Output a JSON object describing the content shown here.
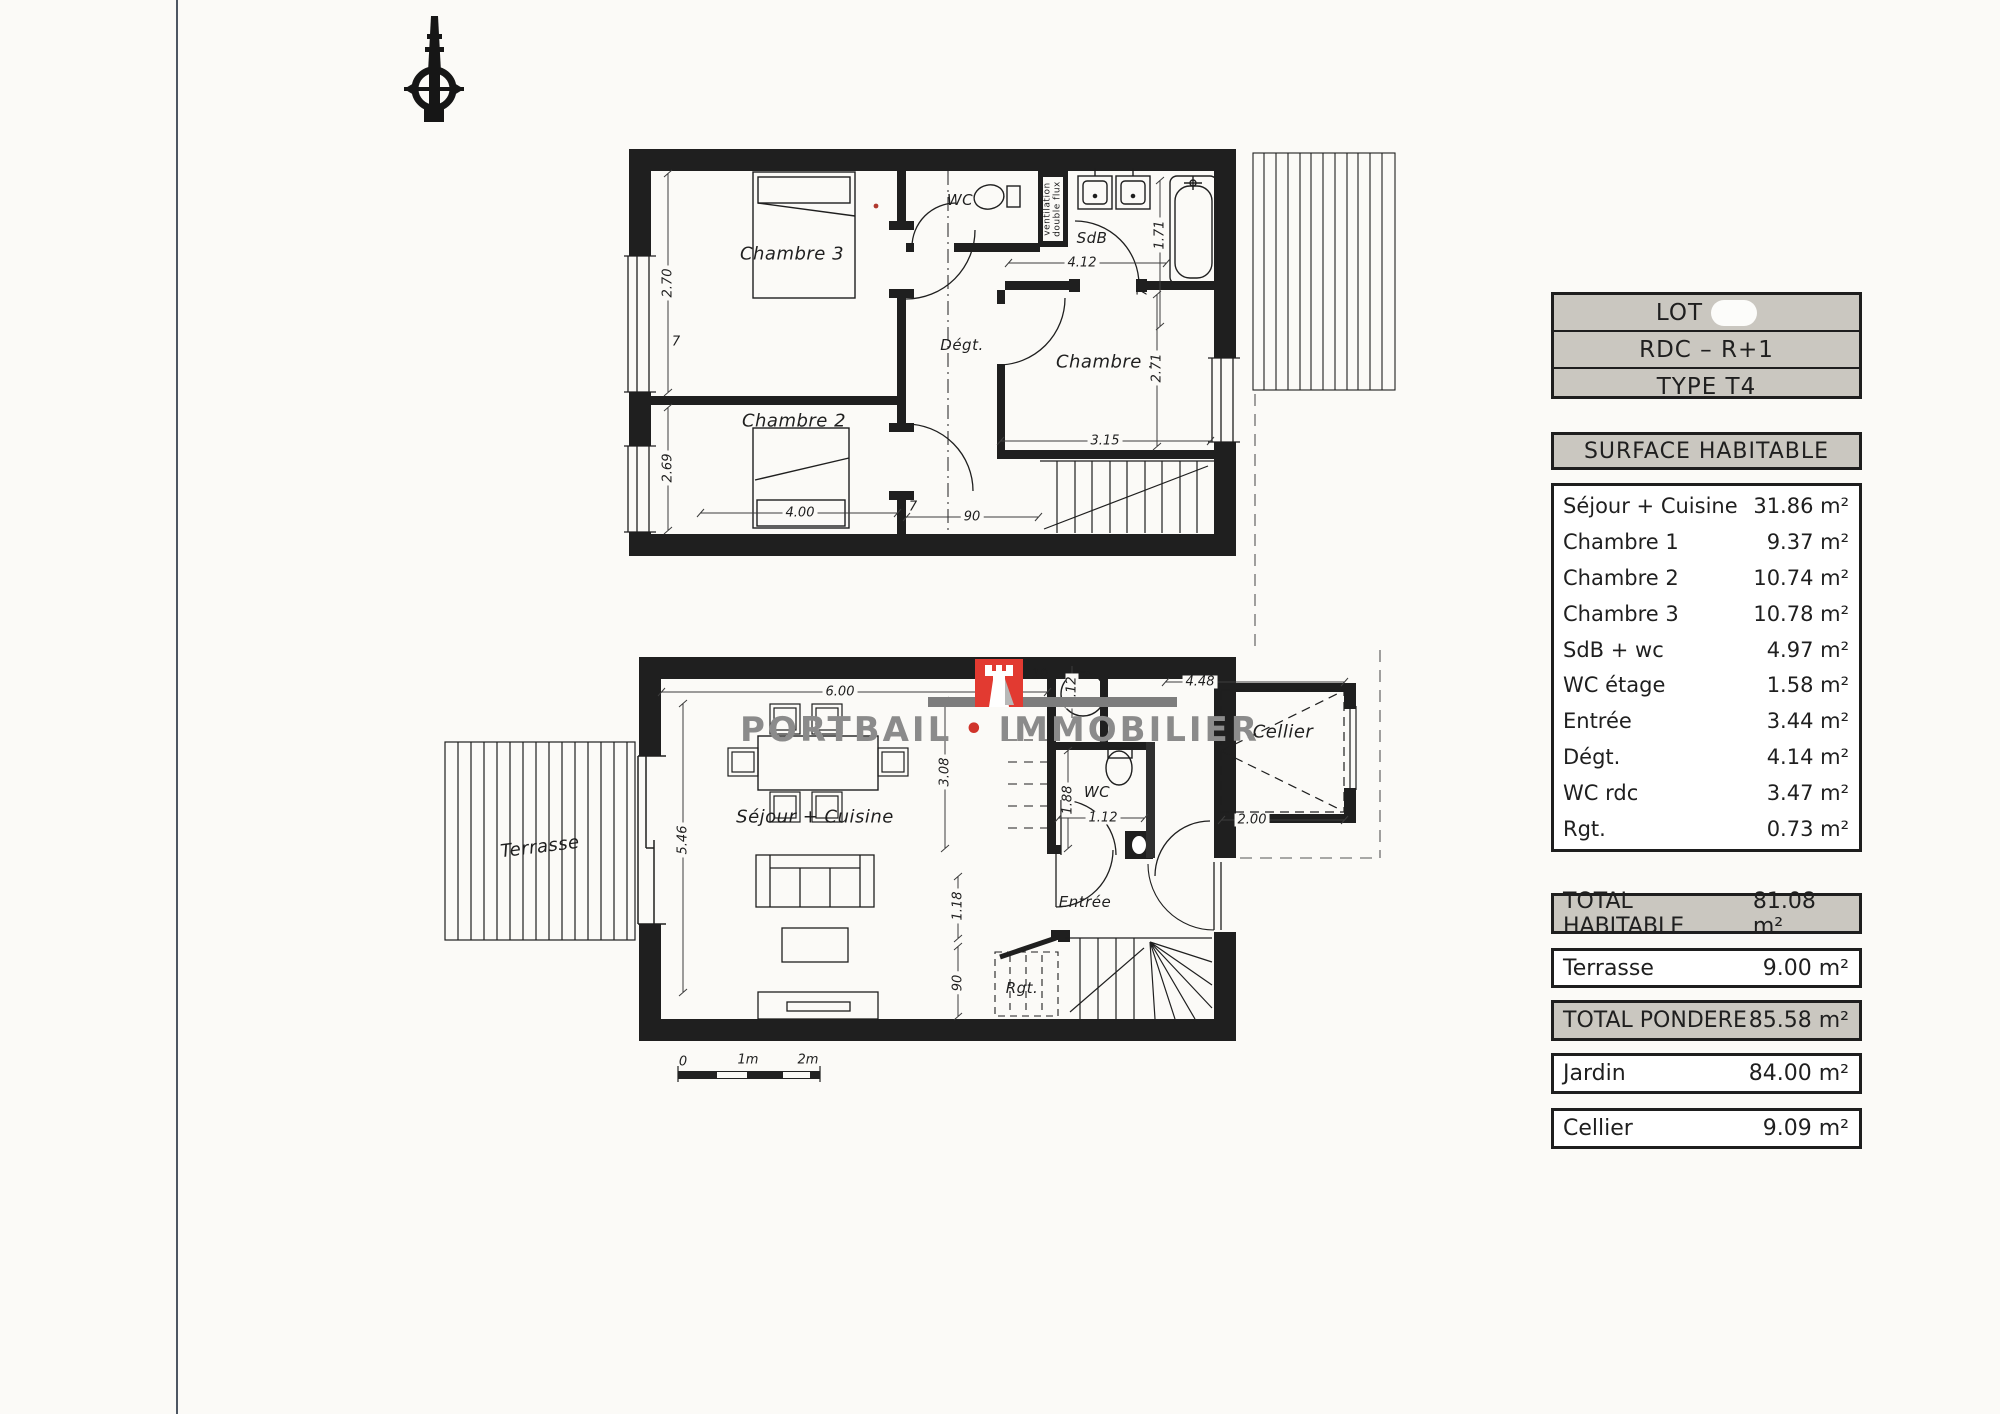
{
  "page": {
    "background": "#fbfaf7",
    "ink": "#1f1f1f",
    "panel_gray": "#cac7c0"
  },
  "compass": {
    "icon": "north-compass"
  },
  "logo": {
    "brand_left": "PORTBAIL",
    "separator": "•",
    "brand_right": "IMMOBILIER",
    "accent_color": "#e23a31",
    "text_color": "#8b8b8b"
  },
  "upper_floor": {
    "name": "R+1",
    "labels": {
      "chambre3": "Chambre 3",
      "chambre2": "Chambre 2",
      "chambre1": "Chambre 1",
      "degagement": "Dégt.",
      "wc": "WC",
      "sdb": "SdB",
      "ventilation": "ventilation double flux"
    },
    "dimensions": {
      "left_top": "2.70",
      "left_bottom": "2.69",
      "bottom": "4.00",
      "corridor": "90",
      "sdb_width": "4.12",
      "bath": "1.71",
      "chambre1_height": "2.71",
      "chambre1_width": "3.15",
      "wall_a": "7",
      "wall_b": "7",
      "wall_c": "7"
    }
  },
  "ground_floor": {
    "name": "RDC",
    "labels": {
      "sejour": "Séjour + Cuisine",
      "terrasse": "Terrasse",
      "cellier": "Cellier",
      "wc": "WC",
      "entree": "Entrée",
      "rangement": "Rgt."
    },
    "dimensions": {
      "top": "6.00",
      "mid_height": "3.08",
      "left_height": "5.46",
      "entree_height": "1.18",
      "entree_low": "90",
      "cellier_top": "4.48",
      "cellier_bottom": "2.00",
      "wc_height": "1.88",
      "wc_width": "1.12",
      "heater": "1.12",
      "jog": "10"
    }
  },
  "scale_bar": {
    "zero": "0",
    "one": "1m",
    "two": "2m"
  },
  "panel": {
    "header": {
      "lot": "LOT",
      "levels": "RDC – R+1",
      "type": "TYPE T4"
    },
    "surface_title": "SURFACE HABITABLE",
    "rooms": [
      {
        "label": "Séjour + Cuisine",
        "value": "31.86 m²"
      },
      {
        "label": "Chambre 1",
        "value": "9.37 m²"
      },
      {
        "label": "Chambre 2",
        "value": "10.74 m²"
      },
      {
        "label": "Chambre 3",
        "value": "10.78 m²"
      },
      {
        "label": "SdB + wc",
        "value": "4.97 m²"
      },
      {
        "label": "WC étage",
        "value": "1.58 m²"
      },
      {
        "label": "Entrée",
        "value": "3.44 m²"
      },
      {
        "label": "Dégt.",
        "value": "4.14 m²"
      },
      {
        "label": "WC rdc",
        "value": "3.47 m²"
      },
      {
        "label": "Rgt.",
        "value": "0.73 m²"
      }
    ],
    "total_habitable": {
      "label": "TOTAL HABITABLE",
      "value": "81.08 m²"
    },
    "terrasse": {
      "label": "Terrasse",
      "value": "9.00 m²"
    },
    "total_pondere": {
      "label": "TOTAL PONDERE",
      "value": "85.58 m²"
    },
    "jardin": {
      "label": "Jardin",
      "value": "84.00 m²"
    },
    "cellier": {
      "label": "Cellier",
      "value": "9.09 m²"
    }
  }
}
